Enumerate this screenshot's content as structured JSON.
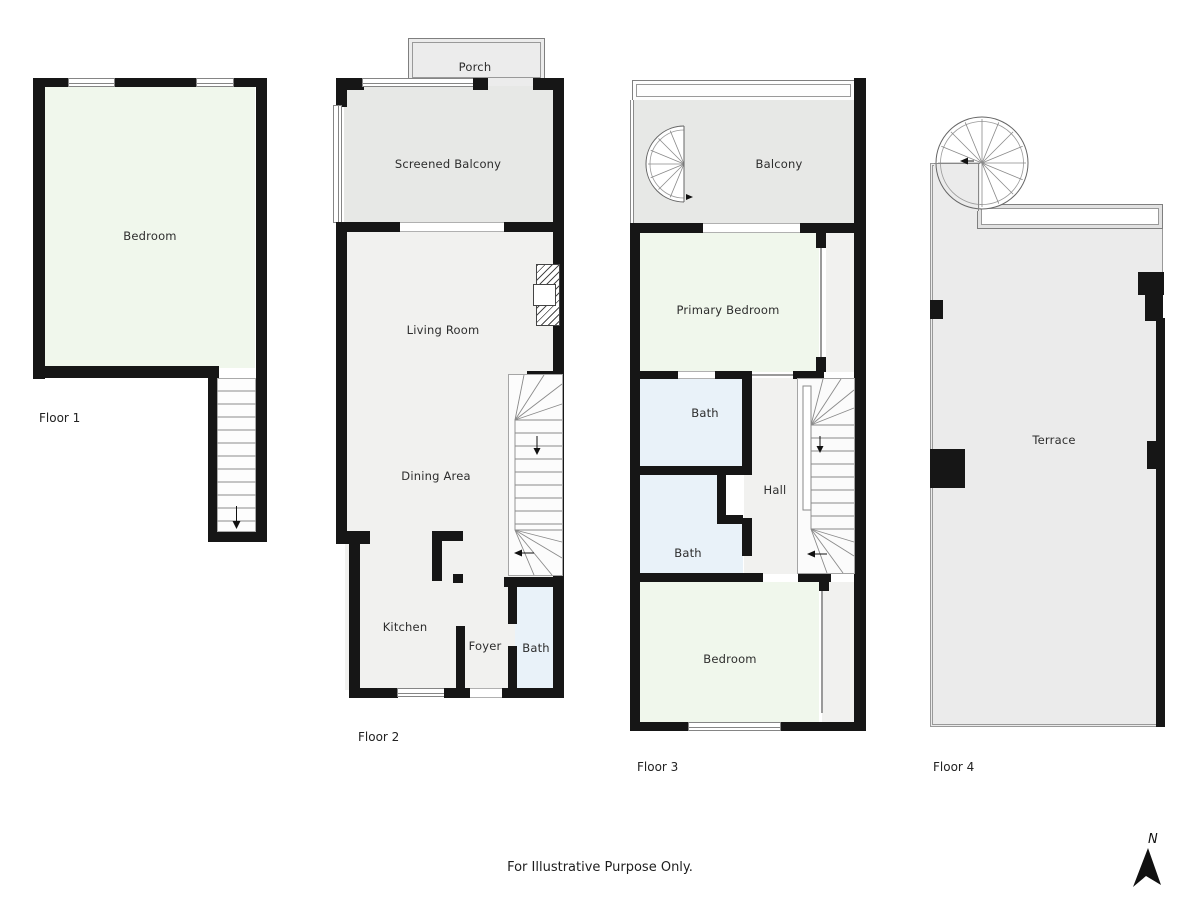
{
  "document": {
    "type": "floor-plan",
    "disclaimer": "For Illustrative Purpose Only."
  },
  "compass": {
    "north": "N"
  },
  "floor1": {
    "caption": "Floor 1",
    "bedroom": "Bedroom"
  },
  "floor2": {
    "caption": "Floor 2",
    "porch": "Porch",
    "screened_balcony": "Screened Balcony",
    "living_room": "Living Room",
    "dining_area": "Dining Area",
    "kitchen": "Kitchen",
    "foyer": "Foyer",
    "bath": "Bath"
  },
  "floor3": {
    "caption": "Floor 3",
    "balcony": "Balcony",
    "primary_bedroom": "Primary Bedroom",
    "bath_upper": "Bath",
    "hall": "Hall",
    "bath_lower": "Bath",
    "bedroom": "Bedroom"
  },
  "floor4": {
    "caption": "Floor 4",
    "terrace": "Terrace"
  },
  "colors": {
    "wall": "#161616",
    "bedroom_fill": "#f0f7ec",
    "bath_fill": "#e9f2f9",
    "balcony_fill": "#e7e8e6",
    "interior_fill": "#f1f1ef",
    "terrace_fill": "#ebebeb",
    "porch_fill": "#ececec",
    "label": "#2d2d2d"
  }
}
